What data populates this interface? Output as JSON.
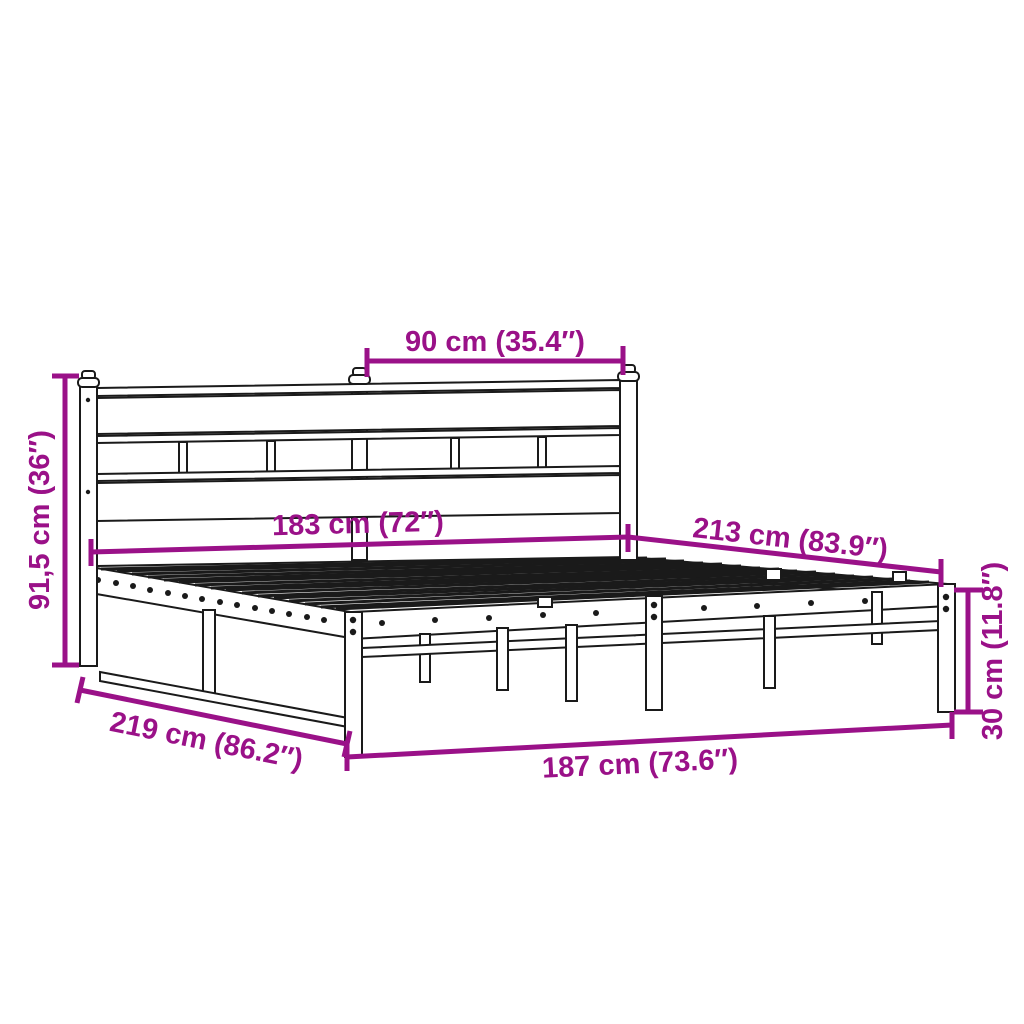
{
  "meta": {
    "background_color": "#ffffff",
    "accent_color": "#9A1188",
    "line_color": "#1a1a1a",
    "description": "Metal bed frame with headboard - product dimension diagram"
  },
  "dimensions": {
    "headboard_half_width": {
      "label": "90 cm (35.4″)"
    },
    "bed_width": {
      "label": "183 cm (72″)"
    },
    "bed_length": {
      "label": "213 cm (83.9″)"
    },
    "headboard_height": {
      "label": "91,5 cm (36″)"
    },
    "outer_length": {
      "label": "219 cm (86.2″)"
    },
    "outer_width": {
      "label": "187 cm (73.6″)"
    },
    "frame_height": {
      "label": "30 cm (11.8″)"
    }
  }
}
